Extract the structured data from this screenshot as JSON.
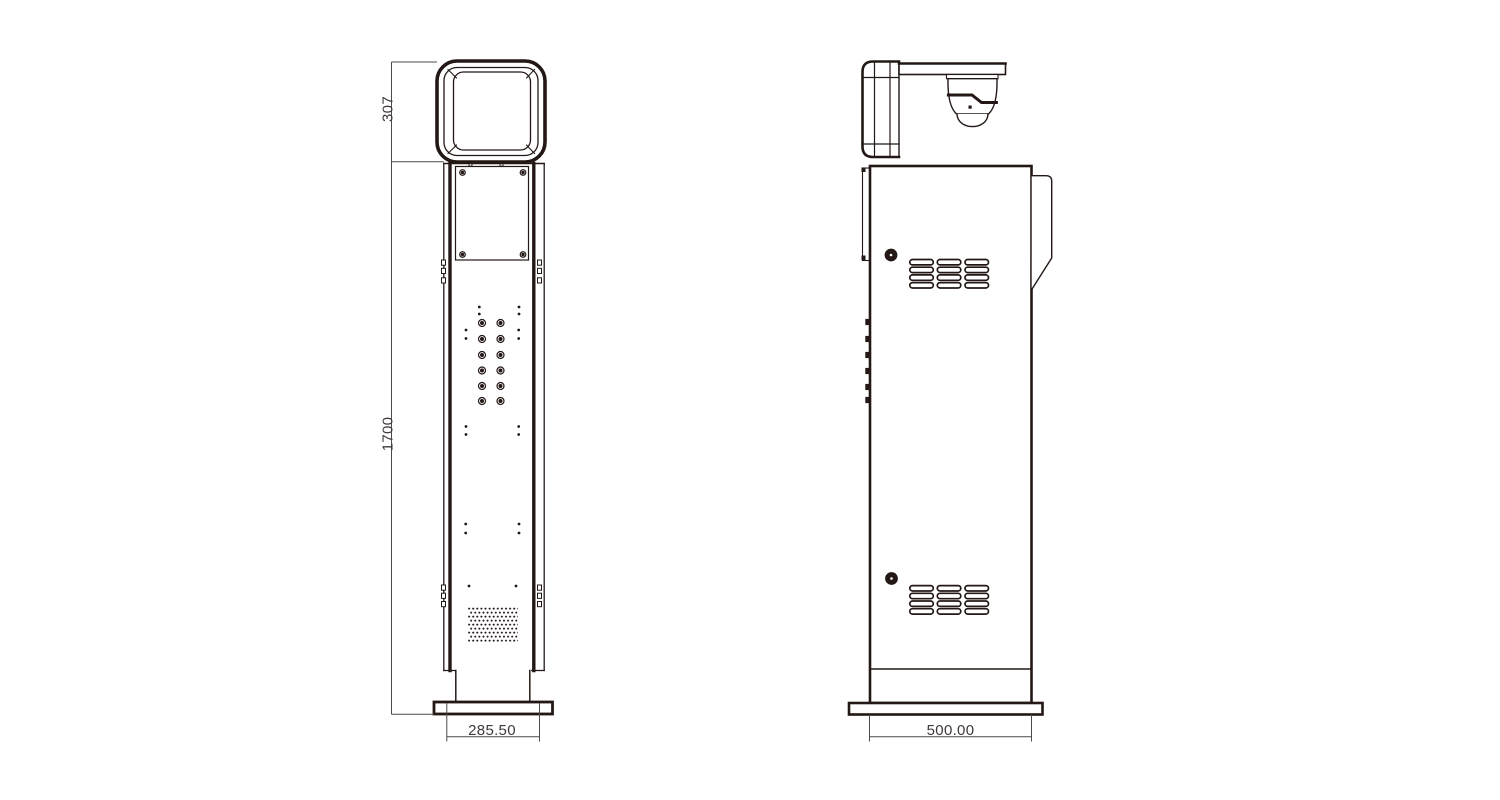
{
  "drawing": {
    "type": "technical-orthographic-drawing",
    "views": {
      "front": "front-view-kiosk-column",
      "side": "side-view-kiosk-column"
    },
    "dimensions": {
      "head_height": "307",
      "body_height": "1700",
      "front_width": "285.50",
      "side_depth": "500.00"
    },
    "colors": {
      "line": "#231815",
      "dimension_line": "#4c4948",
      "text": "#3f3a39",
      "background": "#ffffff"
    }
  }
}
